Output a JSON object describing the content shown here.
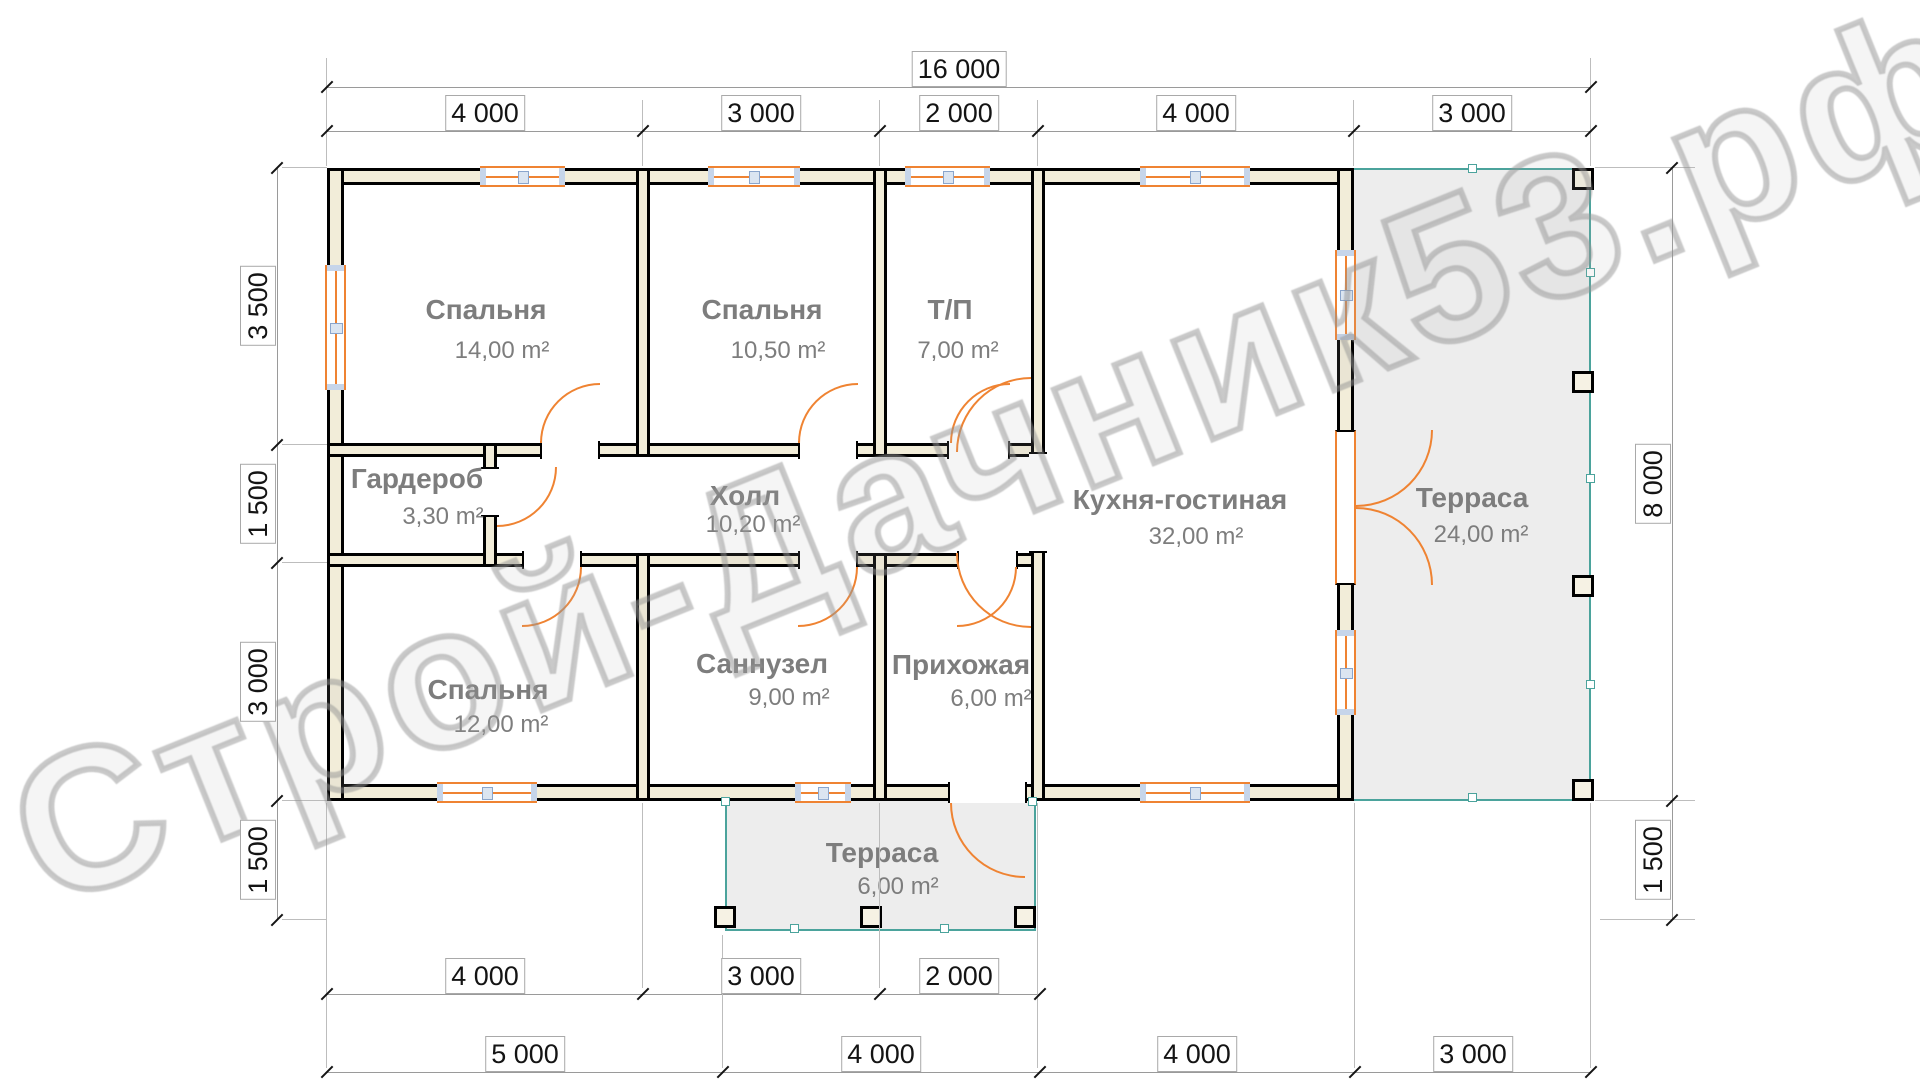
{
  "watermark": "Строй-Дачник53.рф",
  "dimensions": {
    "top_total": "16 000",
    "top_segments": [
      "4 000",
      "3 000",
      "2 000",
      "4 000",
      "3 000"
    ],
    "left_segments": [
      "3 500",
      "1 500",
      "3 000",
      "1 500"
    ],
    "right_segments": [
      "8 000",
      "1 500"
    ],
    "bottom_row1": [
      "4 000",
      "3 000",
      "2 000"
    ],
    "bottom_row2": [
      "5 000",
      "4 000",
      "4 000",
      "3 000"
    ]
  },
  "rooms": [
    {
      "name": "Спальня",
      "area": "14,00 m²"
    },
    {
      "name": "Спальня",
      "area": "10,50 m²"
    },
    {
      "name": "Т/П",
      "area": "7,00 m²"
    },
    {
      "name": "Кухня-гостиная",
      "area": "32,00 m²"
    },
    {
      "name": "Терраса",
      "area": "24,00 m²"
    },
    {
      "name": "Гардероб",
      "area": "3,30 m²"
    },
    {
      "name": "Холл",
      "area": "10,20 m²"
    },
    {
      "name": "Спальня",
      "area": "12,00 m²"
    },
    {
      "name": "Саннузел",
      "area": "9,00 m²"
    },
    {
      "name": "Прихожая",
      "area": "6,00 m²"
    },
    {
      "name": "Терраса",
      "area": "6,00 m²"
    }
  ],
  "colors": {
    "wall_fill": "#f2edd9",
    "opening_accent": "#ef8332",
    "terrace_border": "#4ba39c",
    "terrace_fill": "#ededed",
    "room_label": "#7d7d7d"
  }
}
